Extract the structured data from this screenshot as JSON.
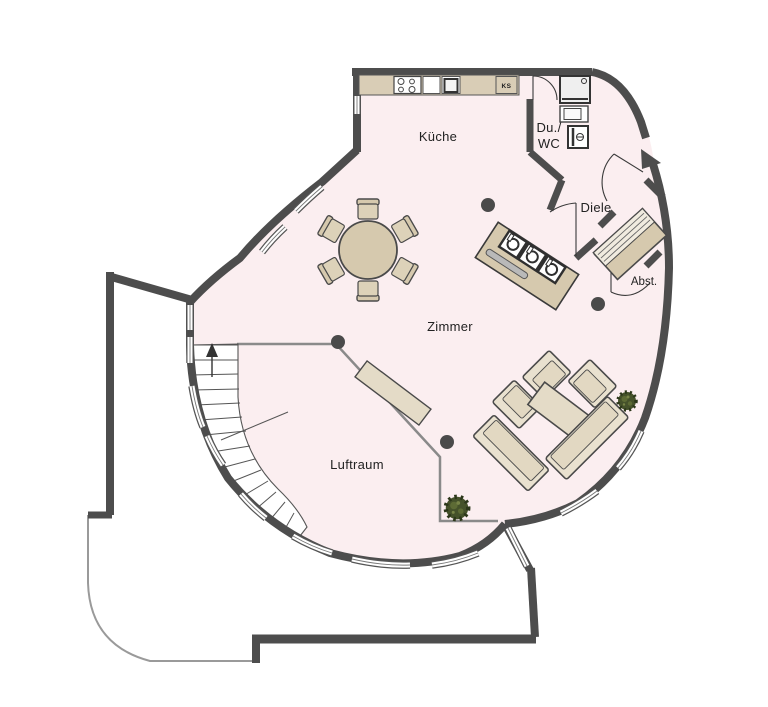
{
  "plan": {
    "type": "floor-plan",
    "rooms": {
      "kueche": "Küche",
      "duwc_line1": "Du./",
      "duwc_line2": "WC",
      "diele": "Diele",
      "abstellraum": "Abst.",
      "zimmer": "Zimmer",
      "luftraum": "Luftraum"
    },
    "appliance_labels": {
      "kuehlschrank": "KS"
    },
    "colors": {
      "wall": "#4d4d4d",
      "floor_pink": "#fbeef0",
      "furniture_tan": "#d6c9ae",
      "furniture_light": "#e9e1cf",
      "plant_green": "#45522a",
      "terrace_line": "#9a9a9a",
      "window_glass": "#ffffff"
    },
    "icons": {
      "stairs_direction": "up-arrow",
      "entrance_marker": "filled-triangle",
      "columns": "filled-dot",
      "plants": "spiky-green-blob"
    }
  }
}
